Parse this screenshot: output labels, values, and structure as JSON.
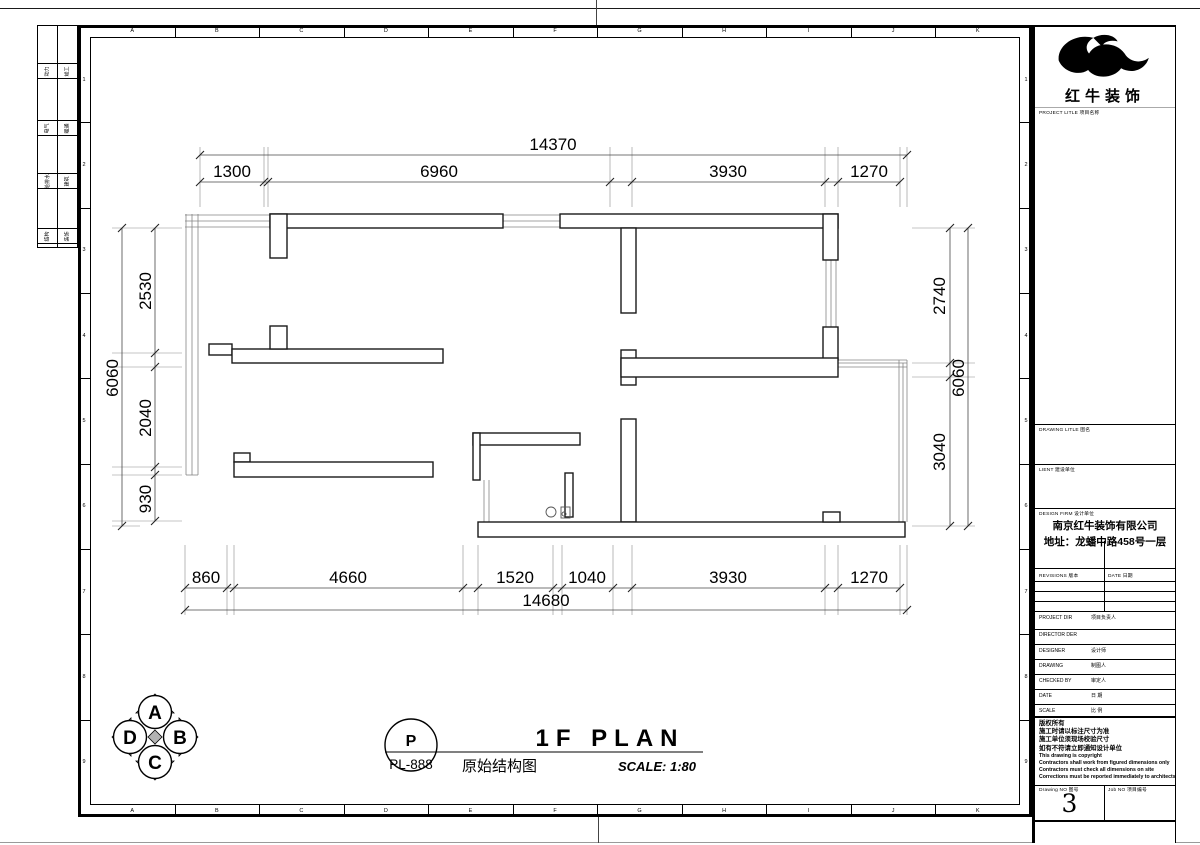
{
  "sheet": {
    "grid_letters": [
      "A",
      "B",
      "C",
      "D",
      "E",
      "F",
      "G",
      "H",
      "I",
      "J",
      "K"
    ],
    "grid_numbers": [
      "1",
      "2",
      "3",
      "4",
      "5",
      "6",
      "7",
      "8",
      "9"
    ],
    "signature_strip": {
      "rows": [
        {
          "left": "动力",
          "right": "竣工"
        },
        {
          "left": "电气",
          "right": "暖通"
        },
        {
          "left": "给排水",
          "right": "建筑"
        },
        {
          "left": "结构",
          "right": "装饰"
        }
      ]
    }
  },
  "plan": {
    "dimensions": {
      "top": {
        "overall": "14370",
        "segments": [
          "1300",
          "6960",
          "3930",
          "1270"
        ]
      },
      "bottom": {
        "overall": "14680",
        "segments": [
          "860",
          "4660",
          "1520",
          "1040",
          "3930",
          "1270"
        ]
      },
      "left": {
        "overall": "6060",
        "segments": [
          "2530",
          "2040",
          "930"
        ]
      },
      "right": {
        "overall": "6060",
        "segments": [
          "2740",
          "3040"
        ]
      }
    },
    "compass": {
      "top": "A",
      "right": "B",
      "bottom": "C",
      "left": "D"
    }
  },
  "titlebar": {
    "bubble_top": "P",
    "bubble_bottom": "PL-888",
    "title": "1F PLAN",
    "subtitle": "原始结构图",
    "scale": "SCALE: 1:80"
  },
  "titleblock": {
    "logo_text": "红牛装饰",
    "project_title_label": "PROJECT LITLE  项目名称",
    "drawing_title_label": "DRAWING LITLE  图名",
    "client_label": "LIENT  建设单位",
    "design_firm_label": "DESIGN FIRM  设计单位",
    "company_name": "南京红牛装饰有限公司",
    "company_address": "地址：龙蟠中路458号一层",
    "revisions_label": "REVISIONS  版本",
    "date_col_label": "DATE  日期",
    "rows": [
      {
        "en": "PROJECT DIR",
        "cn": "项目负责人"
      },
      {
        "en": "DIRECTOR DER",
        "cn": ""
      },
      {
        "en": "DESIGNER",
        "cn": "设计师"
      },
      {
        "en": "DRAWING",
        "cn": "制图人"
      },
      {
        "en": "CHECKED BY",
        "cn": "审定人"
      },
      {
        "en": "DATE",
        "cn": "日  期"
      },
      {
        "en": "SCALE",
        "cn": "比  例"
      }
    ],
    "notes": [
      "版权所有",
      "施工时请以标注尺寸为准",
      "施工单位须现场校验尺寸",
      "如有不符请立即通知设计单位",
      "This drawing is copyright",
      "Contractors shall work from figured dimensions only",
      "Contractors must check all dimensions on site",
      "Corrections must be reported immediately to architects"
    ],
    "drawing_no_label": "Drawing NO  图号",
    "drawing_no": "3",
    "job_no_label": "Job NO  项目编号"
  }
}
